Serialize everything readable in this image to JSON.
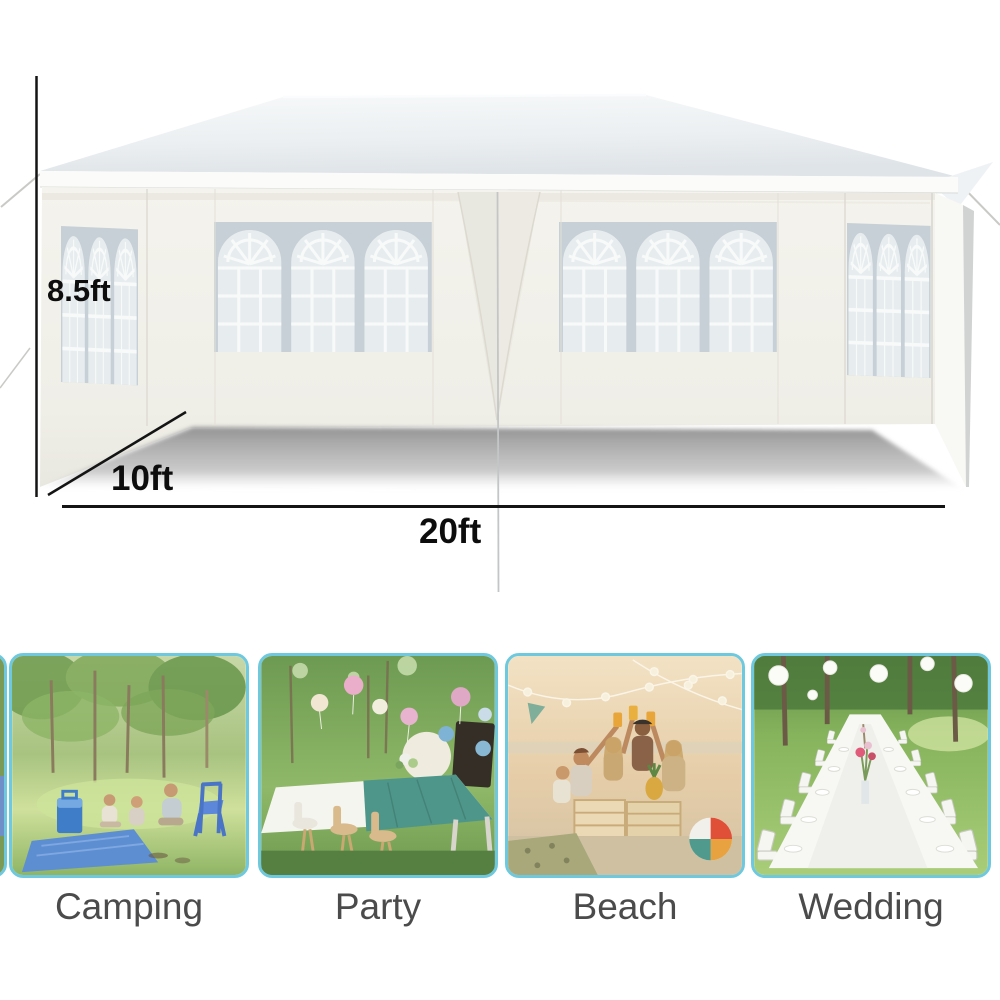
{
  "diagram": {
    "dimension_height_label": "8.5ft",
    "dimension_depth_label": "10ft",
    "dimension_width_label": "20ft"
  },
  "use_cases": [
    {
      "label": "Camping"
    },
    {
      "label": "Party"
    },
    {
      "label": "Beach"
    },
    {
      "label": "Wedding"
    }
  ],
  "colors": {
    "card_border": "#6fc9de",
    "caption_text": "#4b4b4b",
    "dimension_text": "#0d0d0d",
    "tent_fabric": "#f2f1eb",
    "window_frame": "#c7d0d6",
    "window_glass": "#e7edef",
    "floor_shadow": "#a0a0a0"
  }
}
